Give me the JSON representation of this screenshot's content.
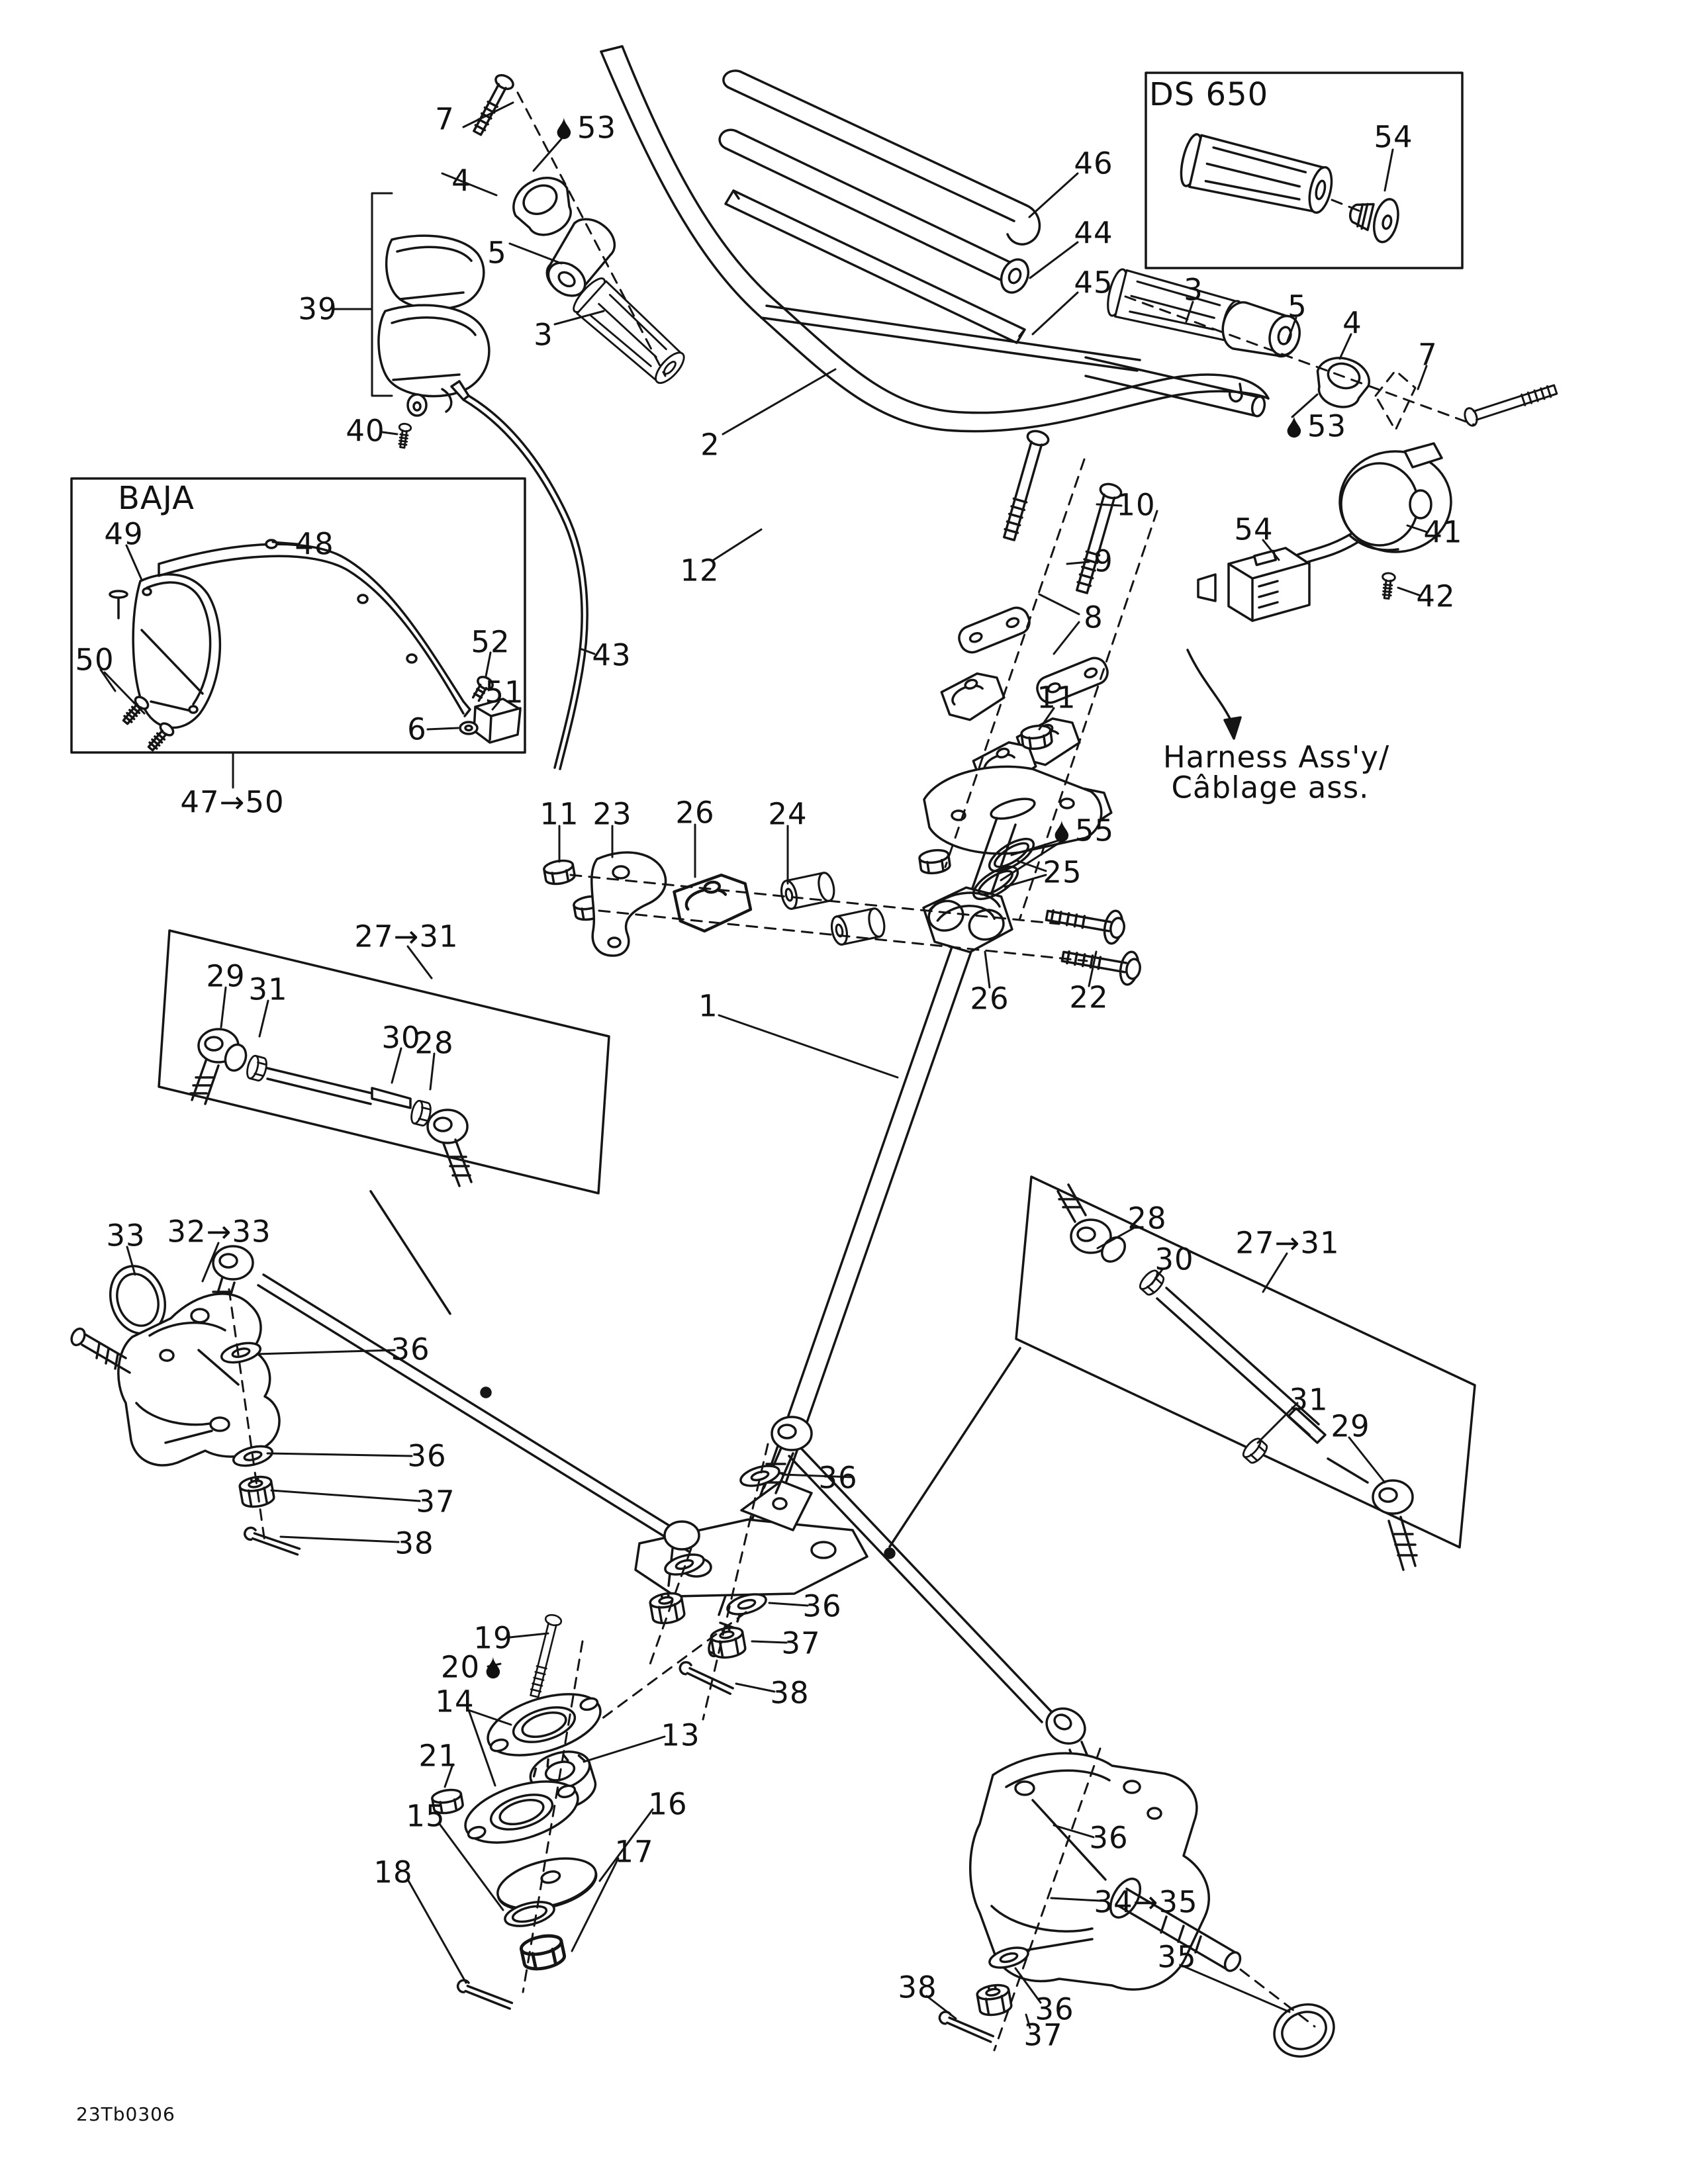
{
  "page": {
    "background": "#ffffff",
    "ink": "#111111",
    "kind": "exploded parts diagram"
  },
  "insets": {
    "ds650_title": "DS 650",
    "baja_title": "BAJA"
  },
  "harness": {
    "line1": "Harness Ass'y/",
    "line2": "Câblage ass."
  },
  "drawing_code": "23Tb0306",
  "icons": {
    "oil_drop": "oil-drop-icon"
  },
  "callouts": [
    {
      "text": "7"
    },
    {
      "icon": "oil-drop",
      "text": "53"
    },
    {
      "text": "4"
    },
    {
      "text": "5"
    },
    {
      "text": "3"
    },
    {
      "text": "39"
    },
    {
      "text": "40"
    },
    {
      "text": "46"
    },
    {
      "text": "44"
    },
    {
      "text": "45"
    },
    {
      "text": "2"
    },
    {
      "text": "12"
    },
    {
      "text": "43"
    },
    {
      "text": "10"
    },
    {
      "text": "9"
    },
    {
      "text": "8"
    },
    {
      "text": "11"
    },
    {
      "text": "DS 650"
    },
    {
      "text": "54"
    },
    {
      "text": "3"
    },
    {
      "text": "5"
    },
    {
      "text": "4"
    },
    {
      "text": "7"
    },
    {
      "icon": "oil-drop",
      "text": "53"
    },
    {
      "text": "41"
    },
    {
      "text": "54"
    },
    {
      "text": "42"
    },
    {
      "text": "Harness Ass'y/"
    },
    {
      "text": "Câblage ass."
    },
    {
      "text": "BAJA"
    },
    {
      "text": "49"
    },
    {
      "text": "48"
    },
    {
      "text": "50"
    },
    {
      "text": "52"
    },
    {
      "text": "51"
    },
    {
      "text": "6"
    },
    {
      "text": "47→50"
    },
    {
      "text": "11"
    },
    {
      "text": "23"
    },
    {
      "text": "26"
    },
    {
      "text": "24"
    },
    {
      "icon": "oil-drop",
      "text": "55"
    },
    {
      "text": "25"
    },
    {
      "text": "26"
    },
    {
      "text": "22"
    },
    {
      "text": "1"
    },
    {
      "text": "27→31"
    },
    {
      "text": "29"
    },
    {
      "text": "31"
    },
    {
      "text": "30"
    },
    {
      "text": "28"
    },
    {
      "text": "33"
    },
    {
      "text": "32→33"
    },
    {
      "text": "36"
    },
    {
      "text": "36"
    },
    {
      "text": "37"
    },
    {
      "text": "38"
    },
    {
      "text": "28"
    },
    {
      "text": "30"
    },
    {
      "text": "27→31"
    },
    {
      "text": "31"
    },
    {
      "text": "29"
    },
    {
      "text": "36"
    },
    {
      "text": "36"
    },
    {
      "text": "37"
    },
    {
      "text": "38"
    },
    {
      "text": "19"
    },
    {
      "icon": "oil-drop",
      "icon_after": true,
      "text": "20"
    },
    {
      "text": "14"
    },
    {
      "text": "13"
    },
    {
      "text": "21"
    },
    {
      "text": "16"
    },
    {
      "text": "15"
    },
    {
      "text": "17"
    },
    {
      "text": "18"
    },
    {
      "text": "36"
    },
    {
      "text": "34→35"
    },
    {
      "text": "35"
    },
    {
      "text": "38"
    },
    {
      "text": "36"
    },
    {
      "text": "37"
    },
    {
      "text": "23Tb0306"
    }
  ]
}
